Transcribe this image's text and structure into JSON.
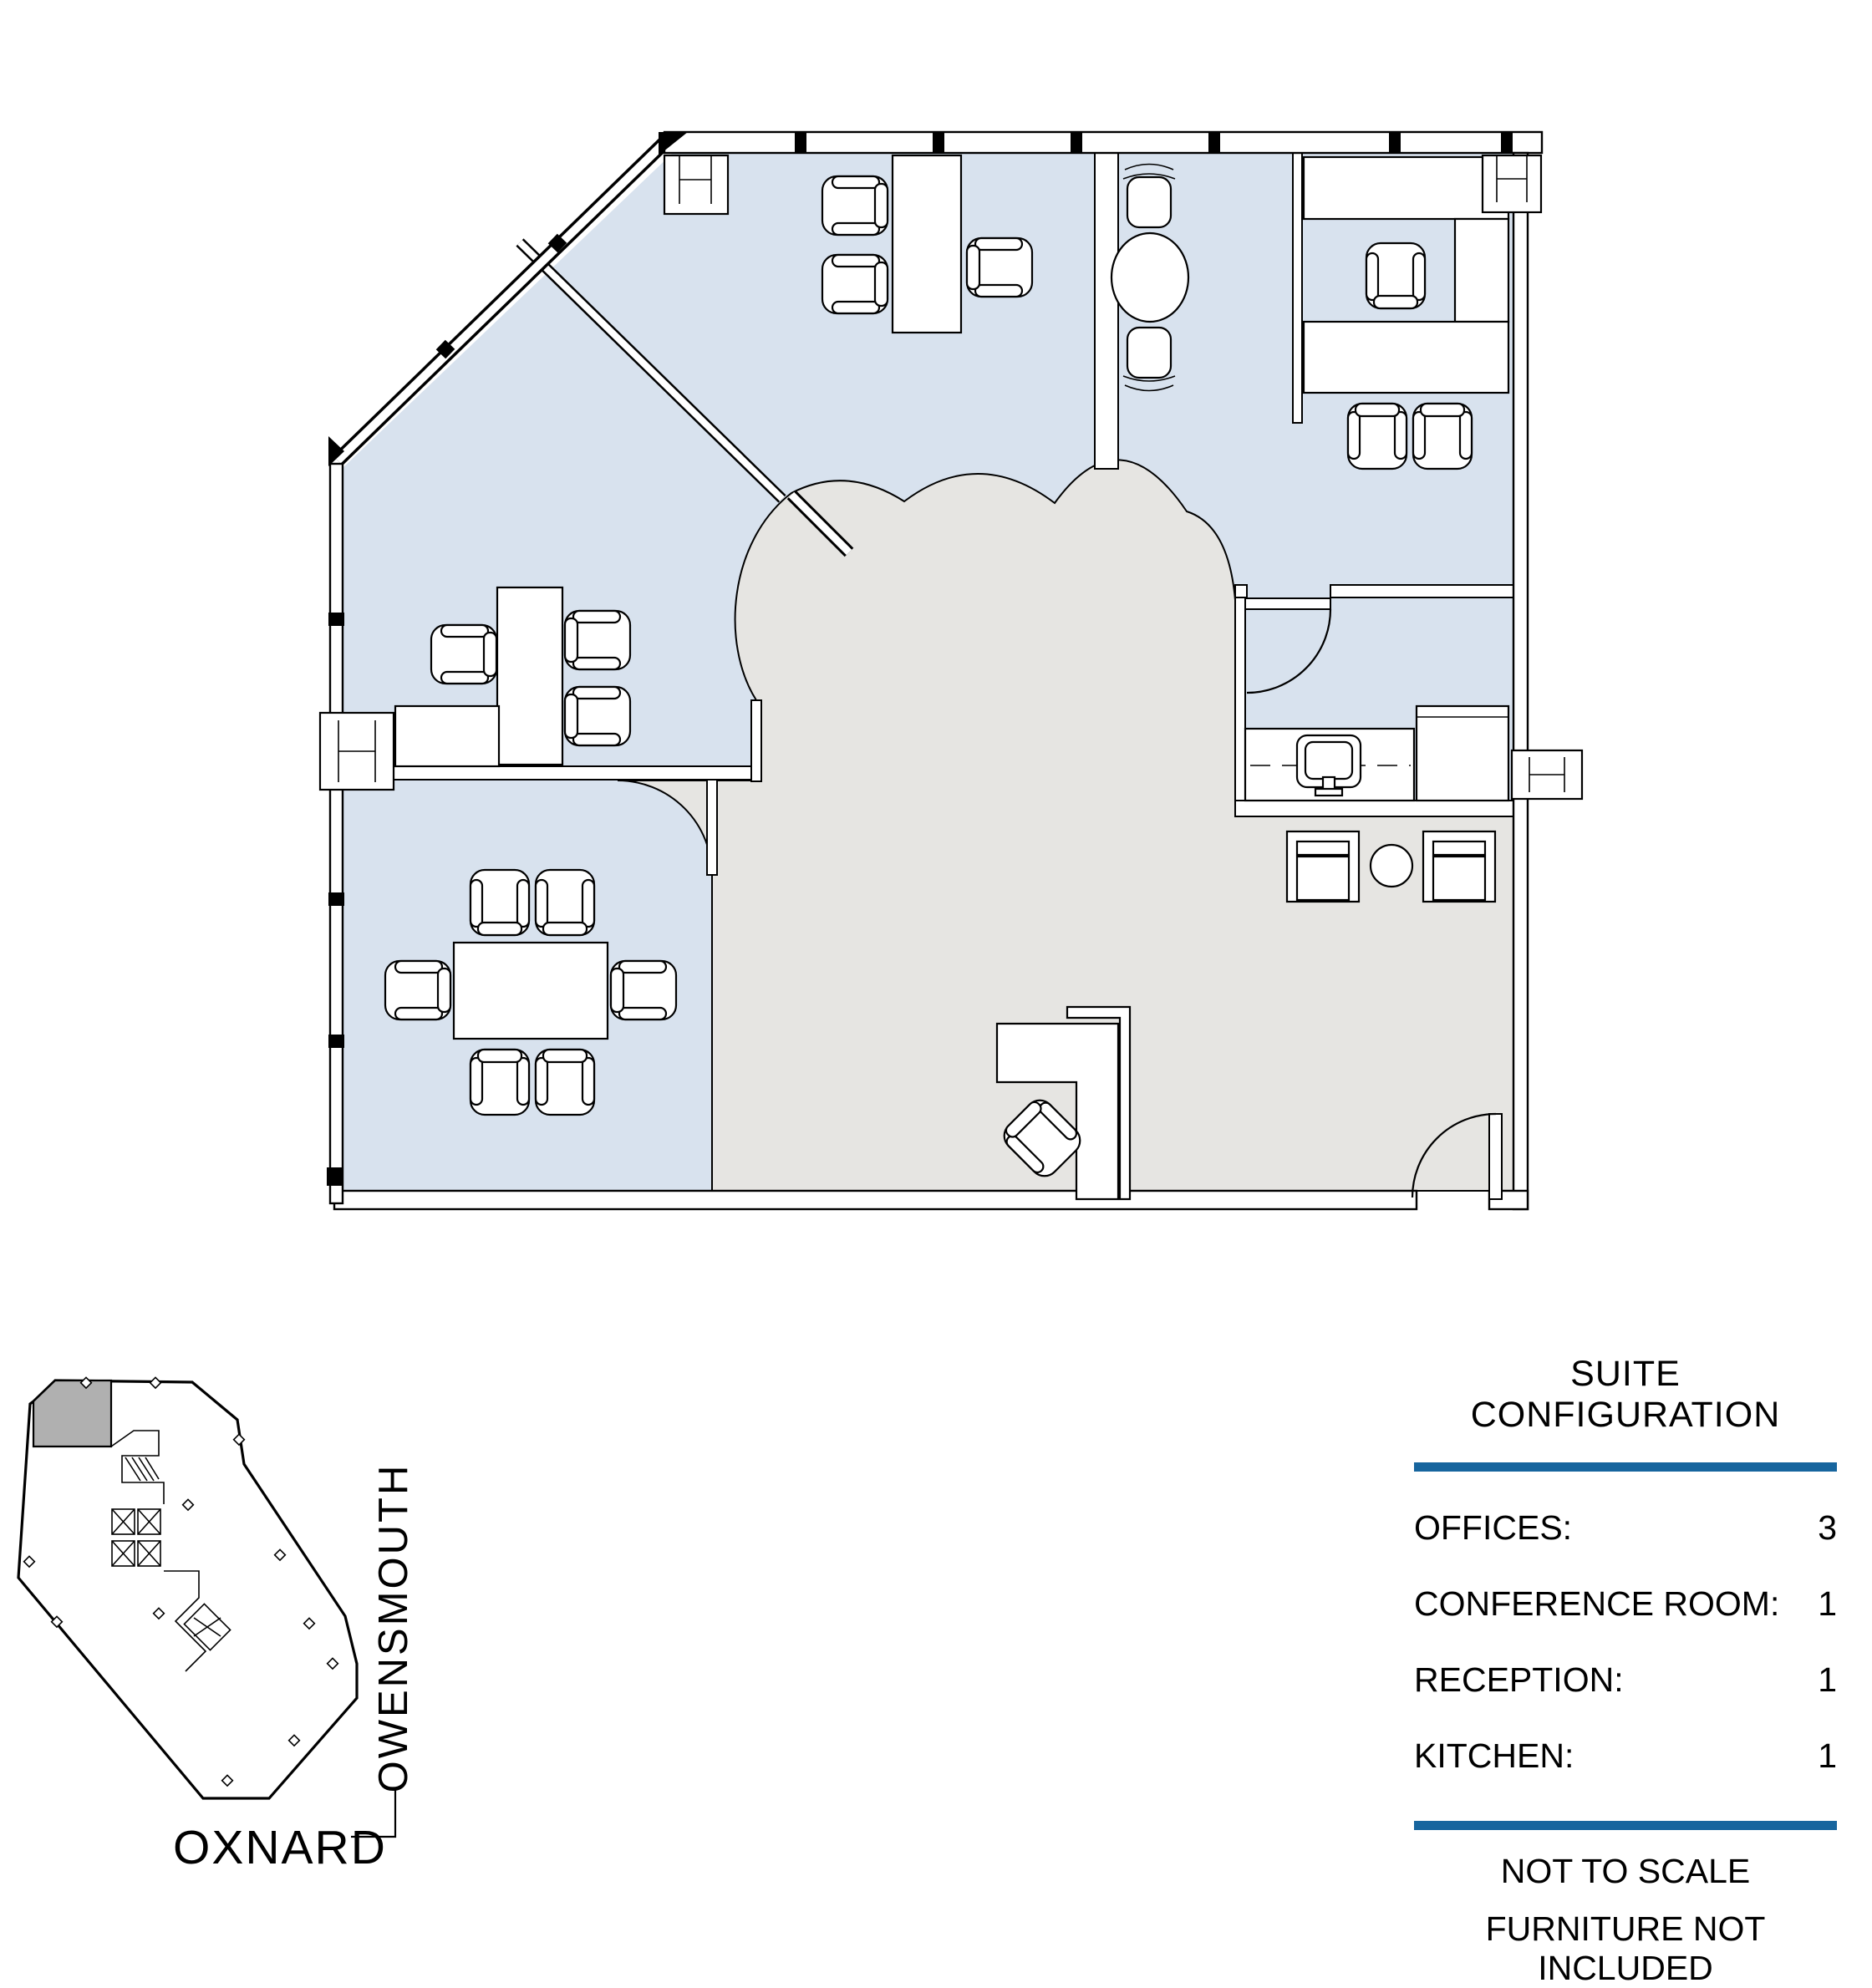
{
  "colors": {
    "room_fill": "#d8e2ee",
    "common_fill": "#e6e5e2",
    "accent_blue": "#17659e",
    "keyplan_gray": "#b0b0b0"
  },
  "legend": {
    "title": "SUITE CONFIGURATION",
    "rows": [
      {
        "label": "OFFICES:",
        "value": "3"
      },
      {
        "label": "CONFERENCE ROOM:",
        "value": "1"
      },
      {
        "label": "RECEPTION:",
        "value": "1"
      },
      {
        "label": "KITCHEN:",
        "value": "1"
      }
    ],
    "notes": [
      "NOT TO SCALE",
      "FURNITURE NOT INCLUDED"
    ]
  },
  "keyplan": {
    "street_side": "OWENSMOUTH",
    "street_bottom": "OXNARD"
  }
}
